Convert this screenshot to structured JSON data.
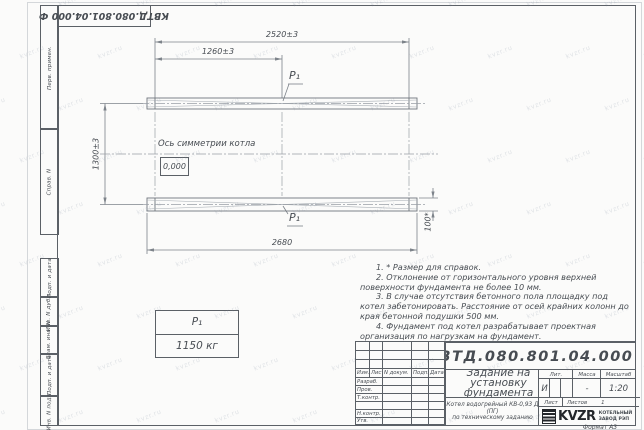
{
  "watermark": {
    "text": "kvzr.ru"
  },
  "top_stamp": {
    "designation": "КВТД.080.801.04.000  Ф"
  },
  "margin_fields": [
    "Перв. примен.",
    "Справ. N",
    "Подп. и дата",
    "Инв. N дубл.",
    "Взам. инв. N",
    "Подп. и дата",
    "Инв. N подл."
  ],
  "drawing": {
    "dims": {
      "overall_top": "2520±3",
      "half_top": "1260±3",
      "height": "1300±3",
      "overall_bottom": "2680",
      "beam_width": "100*"
    },
    "axis_label": "Ось симметрии котла",
    "elevation": "0,000",
    "p1": "P₁"
  },
  "load_table": {
    "name": "P₁",
    "value": "1150 кг"
  },
  "notes": [
    "1. * Размер для справок.",
    "2. Отклонение от горизонтального уровня верхней поверхности фундамента не более 10 мм.",
    "3. В случае отсутствия бетонного пола площадку под котел забетонировать. Расстояние от осей крайних колонн до края бетонной подушки 500 мм.",
    "4. Фундамент под котел разрабатывает проектная организация по нагрузкам на фундамент."
  ],
  "title_block": {
    "designation": "КВТД.080.801.04.000  Ф",
    "doc_title": "Задание на установку фундамента",
    "product": "Котел водогрейный КВ-0,93 Д (ПГ)\nпо техническому заданию",
    "header": {
      "izm": "Изм.",
      "list": "Лист",
      "doc": "N докум.",
      "podp": "Подп.",
      "data": "Дата"
    },
    "rows": [
      "Разраб.",
      "Пров.",
      "Т.контр.",
      "",
      "Н.контр.",
      "Утв."
    ],
    "lit_label": "Лит.",
    "lit_value": "И",
    "mass_label": "Масса",
    "mass_value": "-",
    "scale_label": "Масштаб",
    "scale_value": "1:20",
    "sheet_label": "Лист",
    "sheets_label": "Листов",
    "sheets_value": "1",
    "company": {
      "logo": "KVZR",
      "name": "КОТЕЛЬНЫЙ\nЗАВОД РЭП"
    },
    "format": "Формат А3"
  }
}
